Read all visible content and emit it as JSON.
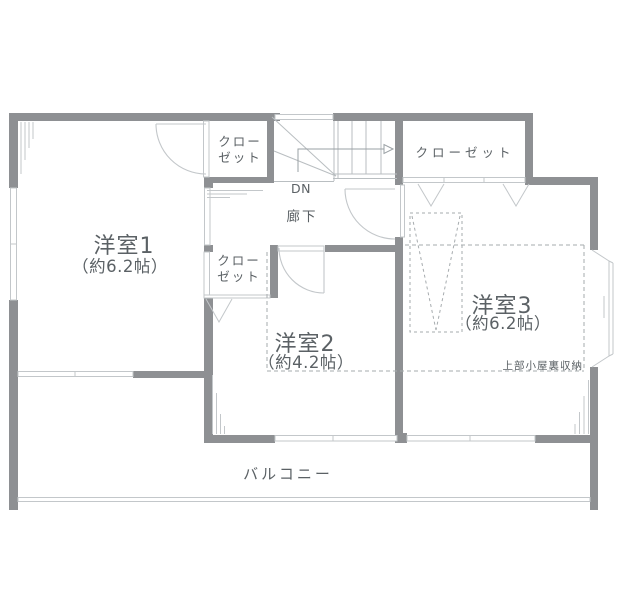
{
  "floorplan": {
    "rooms": {
      "room1": {
        "name": "洋室1",
        "size": "（約6.2帖）"
      },
      "room2": {
        "name": "洋室2",
        "size": "（約4.2帖）"
      },
      "room3": {
        "name": "洋室3",
        "size": "（約6.2帖）"
      }
    },
    "closets": {
      "top_middle": {
        "line1": "クロー",
        "line2": "ゼット"
      },
      "top_right": {
        "label": "クローゼット"
      },
      "middle": {
        "line1": "クロー",
        "line2": "ゼット"
      }
    },
    "hallway": {
      "label": "廊下"
    },
    "stairs": {
      "direction_label": "DN"
    },
    "balcony": {
      "label": "バルコニー"
    },
    "attic_note": {
      "label": "上部小屋裏収納"
    }
  },
  "colors": {
    "wall": "#8e9093",
    "thin_line": "#c3c7ca",
    "stair_line": "#b9bec1",
    "dashed_line": "#a6abae",
    "text": "#5b6165",
    "background": "#ffffff"
  }
}
